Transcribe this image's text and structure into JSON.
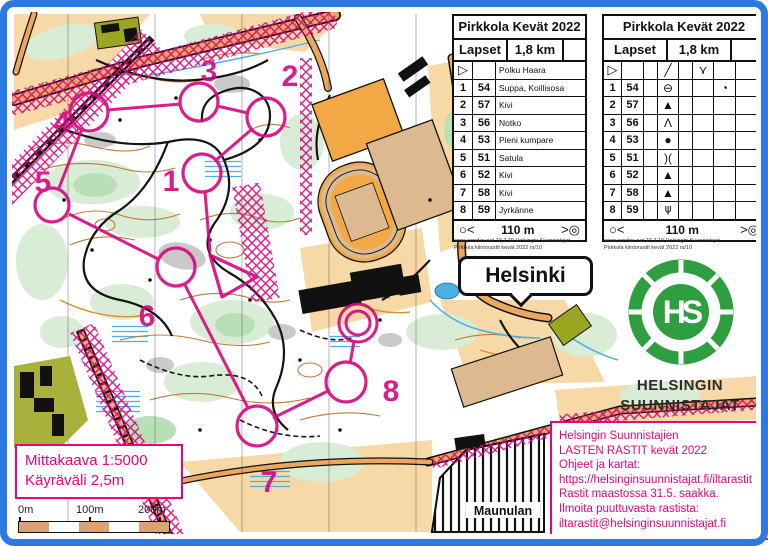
{
  "map": {
    "place_label": "Maunulan",
    "city_callout": "Helsinki",
    "scale_box": {
      "line1": "Mittakaava 1:5000",
      "line2": "Käyräväli 2,5m"
    },
    "scale_bar": {
      "labels": [
        "0m",
        "100m",
        "200m"
      ]
    }
  },
  "course": {
    "color": "#d6057f",
    "controls": [
      {
        "n": "1"
      },
      {
        "n": "2"
      },
      {
        "n": "3"
      },
      {
        "n": "4"
      },
      {
        "n": "5"
      },
      {
        "n": "6"
      },
      {
        "n": "7"
      },
      {
        "n": "8"
      }
    ]
  },
  "sheets": {
    "text": {
      "title": "Pirkkola Kevät 2022",
      "class": "Lapset",
      "length": "1,8 km",
      "start_row": {
        "symbol": "▷",
        "code": "",
        "description": "Polku Haara"
      },
      "rows": [
        {
          "num": "1",
          "code": "54",
          "description": "Suppa, Koillisosa"
        },
        {
          "num": "2",
          "code": "57",
          "description": "Kivi"
        },
        {
          "num": "3",
          "code": "56",
          "description": "Notko"
        },
        {
          "num": "4",
          "code": "53",
          "description": "Pieni kumpare"
        },
        {
          "num": "5",
          "code": "51",
          "description": "Satula"
        },
        {
          "num": "6",
          "code": "52",
          "description": "Kivi"
        },
        {
          "num": "7",
          "code": "58",
          "description": "Kivi"
        },
        {
          "num": "8",
          "code": "59",
          "description": "Jyrkänne"
        }
      ],
      "finish_row": {
        "left": "○<",
        "distance": "110 m",
        "right": ">◎"
      }
    },
    "symbols": {
      "title": "Pirkkola Kevät 2022",
      "class": "Lapset",
      "length": "1,8 km",
      "start_row": {
        "a": "▷",
        "d": "╱",
        "f": "⋎"
      },
      "rows": [
        {
          "num": "1",
          "code": "54",
          "d": "⊖",
          "g": "◔"
        },
        {
          "num": "2",
          "code": "57",
          "d": "▲",
          "g": ""
        },
        {
          "num": "3",
          "code": "56",
          "d": "Λ",
          "g": ""
        },
        {
          "num": "4",
          "code": "53",
          "d": "●",
          "g": ""
        },
        {
          "num": "5",
          "code": "51",
          "d": ")(",
          "g": ""
        },
        {
          "num": "6",
          "code": "52",
          "d": "▲",
          "g": ""
        },
        {
          "num": "7",
          "code": "58",
          "d": "▲",
          "g": ""
        },
        {
          "num": "8",
          "code": "59",
          "d": "⋔",
          "g": ""
        }
      ],
      "finish_row": {
        "left": "○<",
        "distance": "110 m",
        "right": ">◎"
      }
    }
  },
  "attribution": {
    "line1": "www.condes.net 10.2.19 Helsingin Suunnistajat",
    "line2": "Pirkkola kiintorastit kevät 2022 rs/10"
  },
  "club": {
    "monogram": "HS",
    "name_line1": "HELSINGIN",
    "name_line2": "SUUNNISTAJAT",
    "logo_color": "#2f9e41"
  },
  "info_box": {
    "color": "#e6057d",
    "lines": [
      "Helsingin Suunnistajien",
      "LASTEN RASTIT kevät 2022",
      "Ohjeet ja kartat:",
      "https://helsinginsuunnistajat.fi/iltarastit",
      "Rastit maastossa 31.5. saakka.",
      "Ilmoita puuttuvasta rastista:",
      "iltarastit@helsinginsuunnistajat.fi"
    ]
  }
}
